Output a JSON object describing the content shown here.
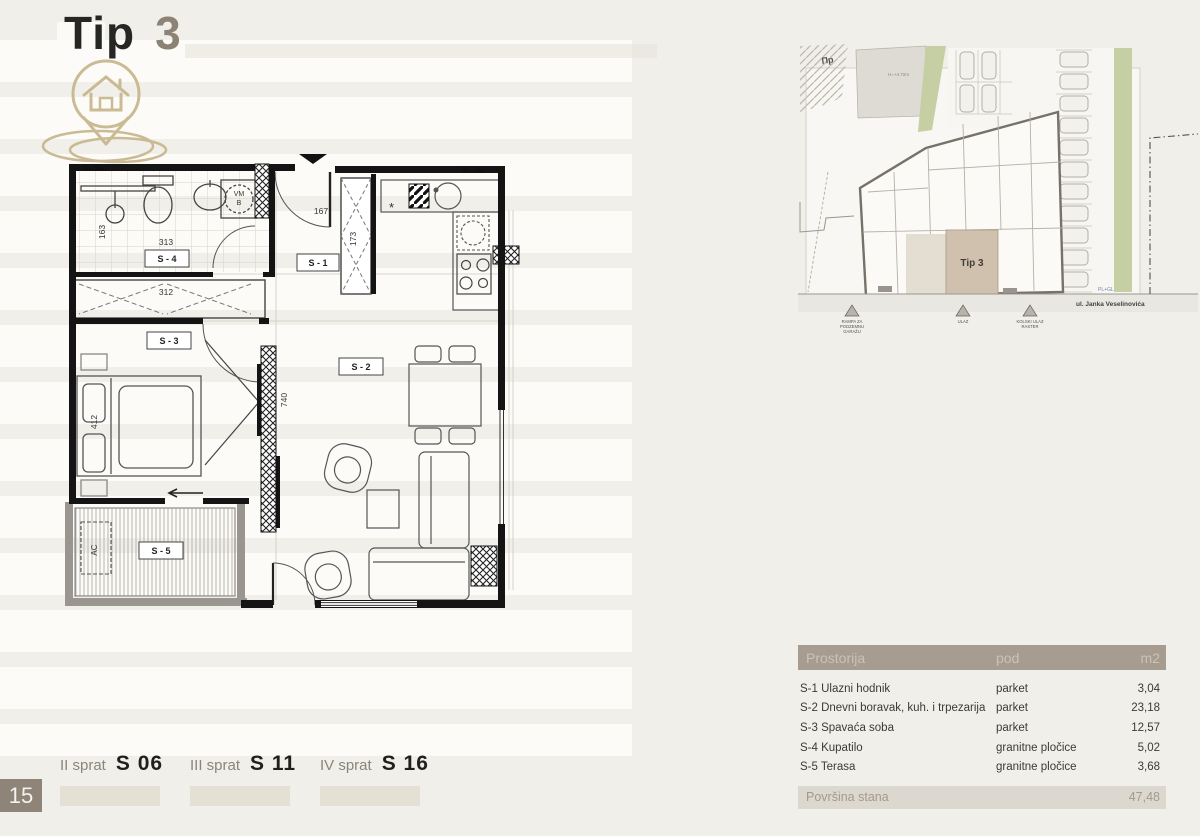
{
  "title": {
    "word": "Tip",
    "number": "3"
  },
  "page_number": "15",
  "floor_plan": {
    "rooms": {
      "s1": "S - 1",
      "s2": "S - 2",
      "s3": "S - 3",
      "s4": "S - 4",
      "s5": "S - 5"
    },
    "dims": {
      "d163": "163",
      "d313": "313",
      "d312": "312",
      "d412": "412",
      "d167": "167",
      "d173": "173",
      "d740": "740"
    },
    "labels": {
      "vm": "VM",
      "b": "B",
      "ac": "AC",
      "asterisk": "*"
    }
  },
  "site_plan": {
    "zone_label": "Пp",
    "height_label": "H=+4.72m",
    "unit_label": "Tip 3",
    "street": "ul. Janka Veselinovića",
    "utility": "PL+GL",
    "markers": [
      {
        "lines": [
          "RAMPA ZA",
          "PODZEMNU",
          "GARAŽU"
        ]
      },
      {
        "lines": [
          "ULAZ"
        ]
      },
      {
        "lines": [
          "KOLSKI ULAZ",
          "RASTER"
        ]
      }
    ]
  },
  "table": {
    "headers": {
      "room": "Prostorija",
      "floor": "pod",
      "unit": "m2"
    },
    "rows": [
      {
        "name": "S-1 Ulazni hodnik",
        "floor": "parket",
        "area": "3,04"
      },
      {
        "name": "S-2 Dnevni boravak, kuh. i trpezarija",
        "floor": "parket",
        "area": "23,18"
      },
      {
        "name": "S-3 Spavaća soba",
        "floor": "parket",
        "area": "12,57"
      },
      {
        "name": "S-4 Kupatilo",
        "floor": "granitne pločice",
        "area": "5,02"
      },
      {
        "name": "S-5 Terasa",
        "floor": "granitne pločice",
        "area": "3,68"
      }
    ],
    "footer": {
      "label": "Površina stana",
      "value": "47,48"
    }
  },
  "floors": [
    {
      "level": "II sprat",
      "unit": "S 06"
    },
    {
      "level": "III sprat",
      "unit": "S 11"
    },
    {
      "level": "IV sprat",
      "unit": "S 16"
    }
  ]
}
